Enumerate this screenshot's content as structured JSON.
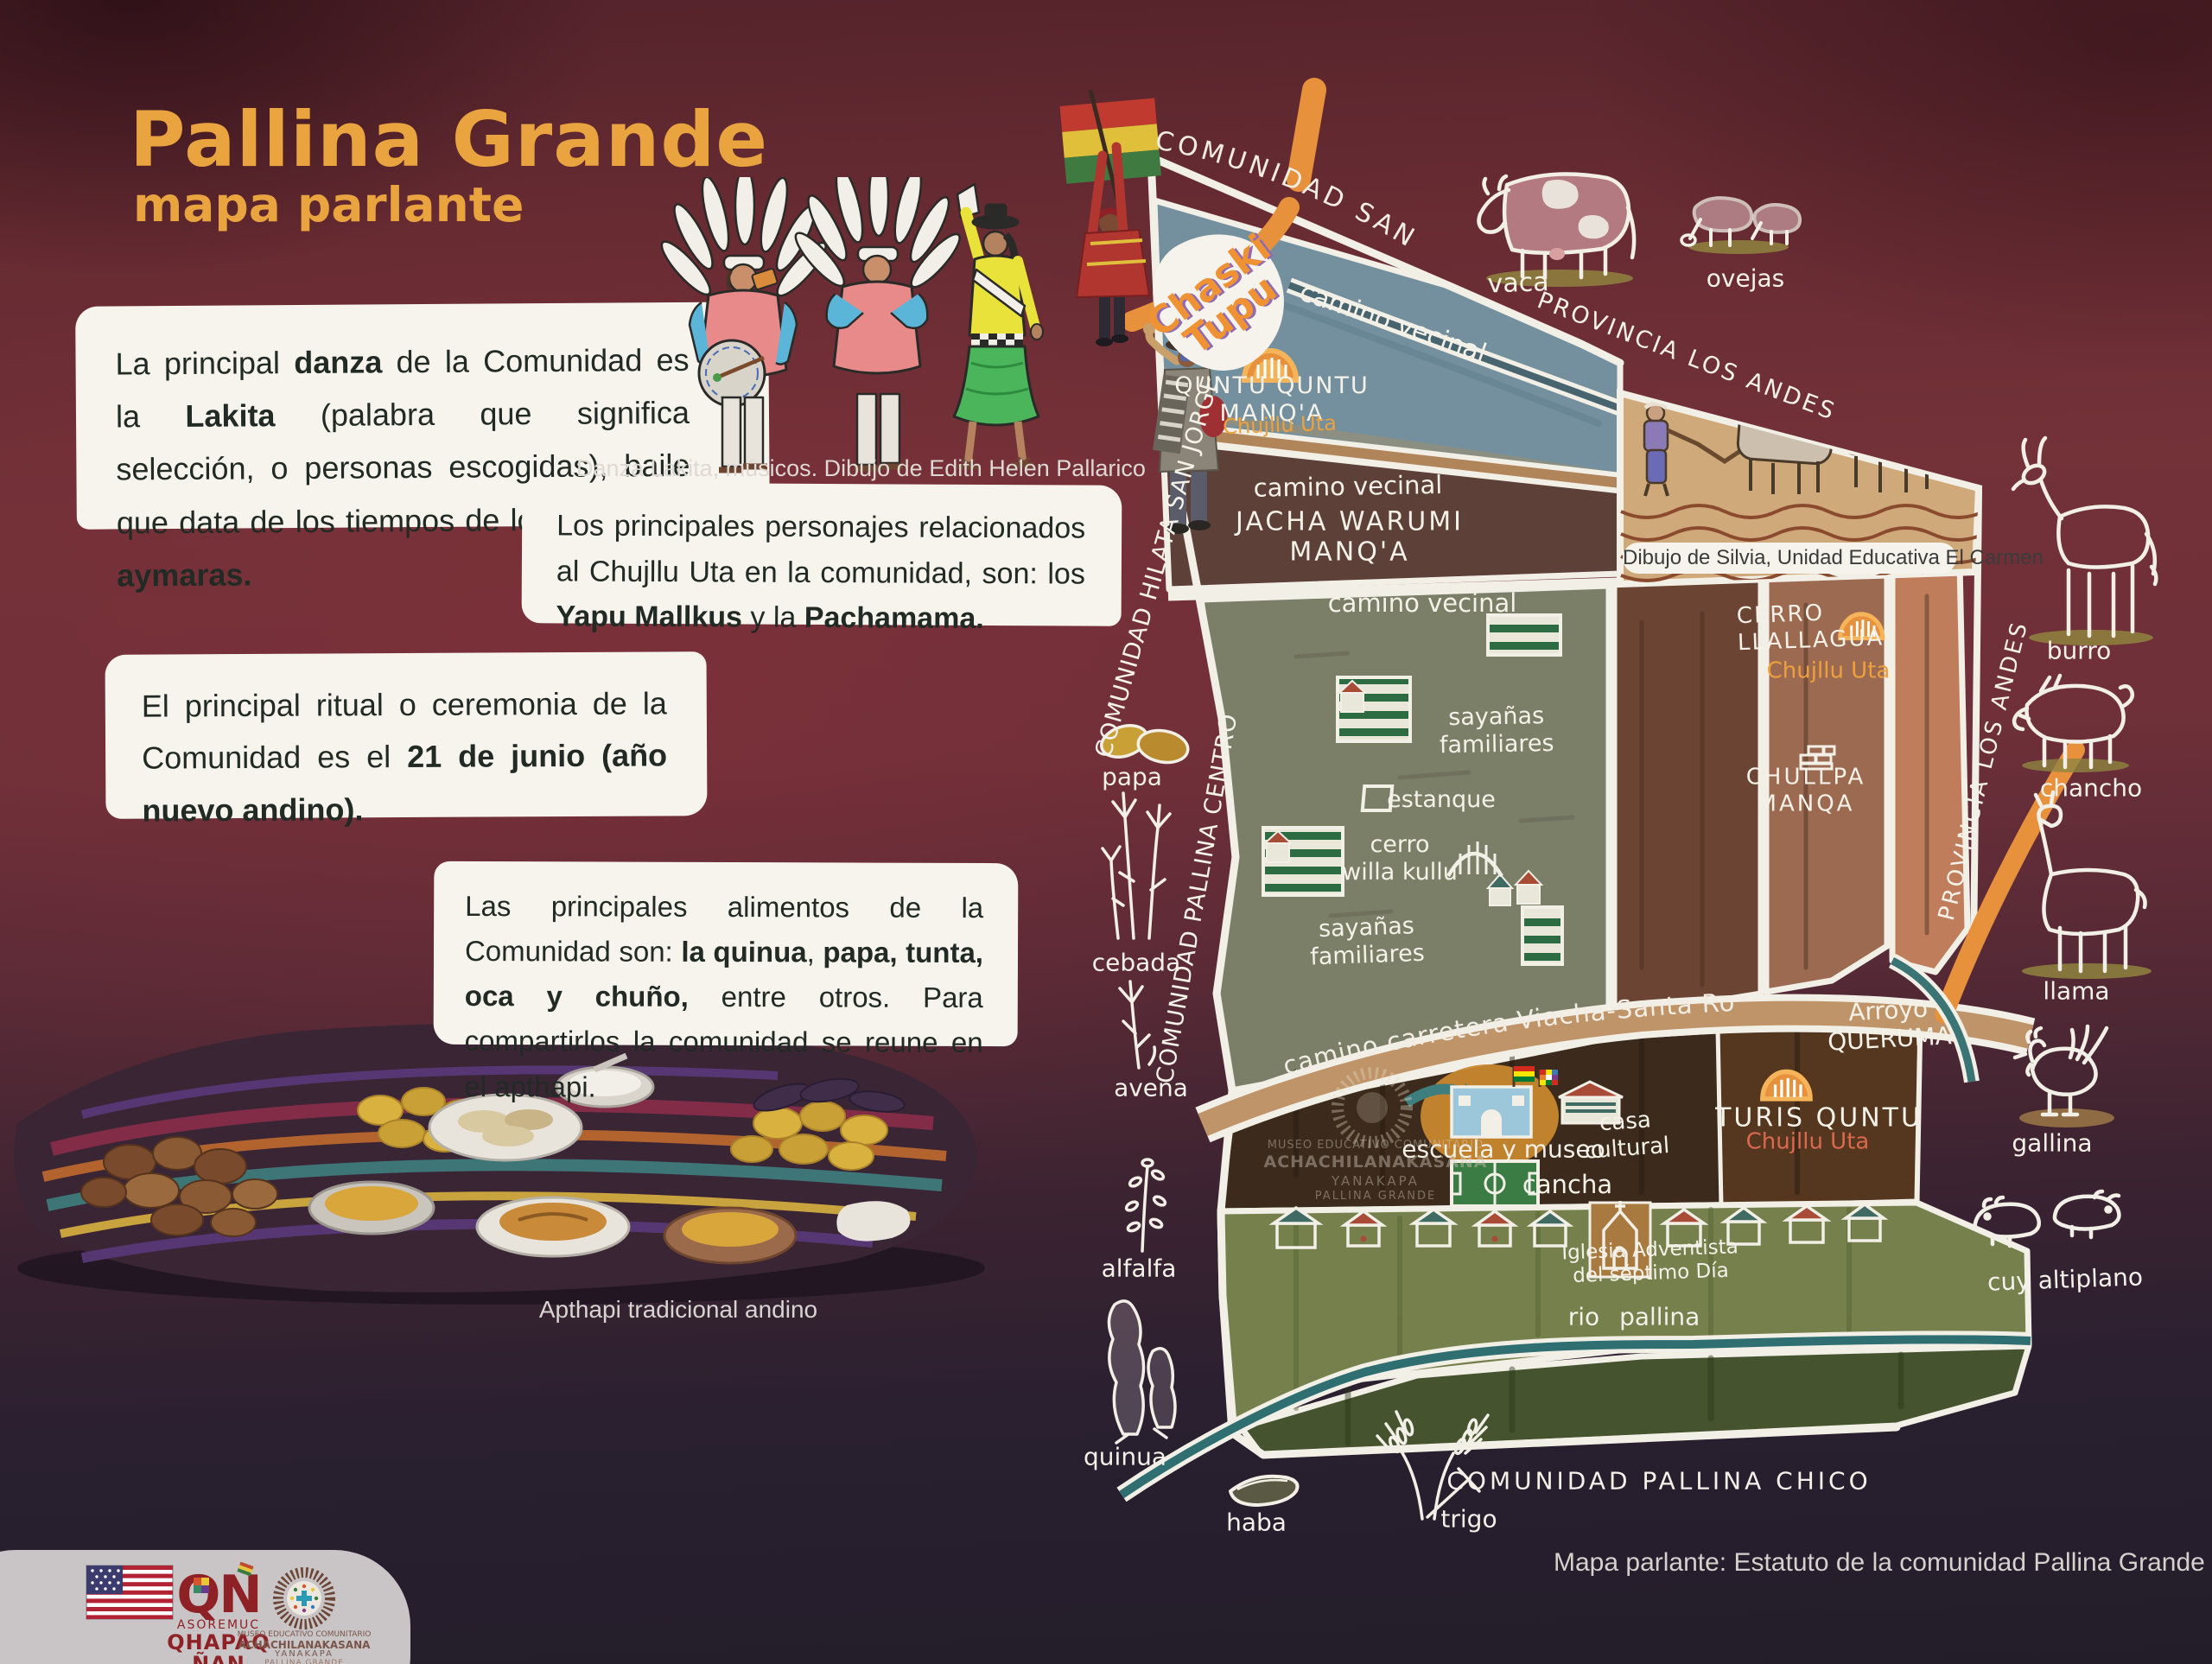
{
  "title": {
    "main": "Pallina Grande",
    "subtitle": "mapa parlante"
  },
  "blocks": {
    "danza": [
      {
        "t": "La principal "
      },
      {
        "t": "danza",
        "b": 1
      },
      {
        "t": " de la Comunidad es la "
      },
      {
        "t": "Lakita",
        "b": 1
      },
      {
        "t": " (palabra que significa selección, o personas escogidas), baile que data de los tiempos de los "
      },
      {
        "t": "señoríos aymaras.",
        "b": 1
      }
    ],
    "danza_caption": "Danza Lakita, músicos. Dibujo de Edith Helen Pallarico",
    "personajes": [
      {
        "t": "Los principales personajes relacionados al Chujllu Uta en la comunidad, son: los "
      },
      {
        "t": "Yapu Mallkus",
        "b": 1
      },
      {
        "t": " y la "
      },
      {
        "t": "Pachamama.",
        "b": 1
      }
    ],
    "ritual": [
      {
        "t": "El principal ritual o ceremonia de la Comunidad es el "
      },
      {
        "t": "21 de junio (año nuevo andino).",
        "b": 1
      }
    ],
    "alimentos": [
      {
        "t": "Las principales alimentos de la Comunidad son: "
      },
      {
        "t": "la quinua",
        "b": 1
      },
      {
        "t": ", "
      },
      {
        "t": "papa, tunta, oca y chuño,",
        "b": 1
      },
      {
        "t": " entre otros. Para compartirlos la comunidad se reune en el apthapi."
      }
    ],
    "apthapi_caption": "Apthapi tradicional andino"
  },
  "map": {
    "labels": {
      "santa_rosa": "COMUNIDAD SANTA ROSA",
      "chaski": [
        "Chaski",
        "Tupu"
      ],
      "camino_vecinal_1": "camino vecinal",
      "camino_vecinal_2": "camino vecinal",
      "camino_vecinal_3": "camino vecinal",
      "quntu_quntu": [
        "QUNTU QUNTU",
        "MANQ'A"
      ],
      "chujllu_uta_1": "Chujllu Uta",
      "vaca": "vaca",
      "ovejas": "ovejas",
      "provincia_top": "PROVINCIA LOS ANDES",
      "provincia_right": "PROVINCIA LOS ANDES",
      "jacha_warumi": [
        "JACHA WARUMI",
        "MANQ'A"
      ],
      "dibujo_caption": "Dibujo de Silvia, Unidad Educativa El Carmen",
      "cerro_llallagua": [
        "CERRO",
        "LLALLAGUA"
      ],
      "chujllu_uta_2": "Chujllu Uta",
      "chullpa_manqa": [
        "CHULLPA",
        "MANQA"
      ],
      "burro": "burro",
      "chancho": "chancho",
      "llama": "llama",
      "gallina": "gallina",
      "cuy": "cuy altiplano",
      "papa": "papa",
      "cebada": "cebada",
      "avena": "avena",
      "alfalfa": "alfalfa",
      "quinua": "quinua",
      "haba": "haba",
      "trigo": "trigo",
      "hilata": "COMUNIDAD HILATA SAN JORGE",
      "pallina_centro": "COMUNIDAD PALLINA CENTRO",
      "pallina_chico": "COMUNIDAD PALLINA CHICO",
      "sayanas_1": [
        "sayañas",
        "familiares"
      ],
      "sayanas_2": [
        "sayañas",
        "familiares"
      ],
      "estanque": "estanque",
      "cerro_willa": [
        "cerro",
        "willa kullu"
      ],
      "carretera": "camino carretera Viacha-Santa Rosa",
      "arroyo": [
        "Arroyo",
        "QUERUMA"
      ],
      "escuela": "escuela y museo",
      "casa_cultural": [
        "casa",
        "cultural"
      ],
      "cancha": "cancha",
      "turis_quntu": "TURIS QUNTU",
      "chujllu_uta_3": "Chujllu Uta",
      "iglesia": [
        "Iglesia Adventista",
        "del séptimo Día"
      ],
      "rio_pallina": "rio  pallina",
      "watermark": [
        "MUSEO EDUCATIVO COMUNITARIO",
        "ACHACHILANAKASANA",
        "YANAKAPA",
        "PALLINA GRANDE"
      ]
    }
  },
  "captions": {
    "map_source": "Mapa parlante: Estatuto de la comunidad Pallina Grande"
  },
  "footer": {
    "asoremuc": [
      "ASOREMUC",
      "QHAPAQ",
      "ÑAN"
    ],
    "museo": [
      "MUSEO EDUCATIVO COMUNITARIO",
      "ACHACHILANAKASANA",
      "YANAKAPA",
      "PALLINA GRANDE"
    ],
    "flag_icon": "us-flag"
  },
  "colors": {
    "title_orange": "#e9a440",
    "map_ink": "#f4f1e8",
    "road_orange": "#e8913d",
    "chujllu_orange": "#eda03c",
    "chujllu_red": "#d96a4f",
    "background_maroon": "#6f3039"
  }
}
